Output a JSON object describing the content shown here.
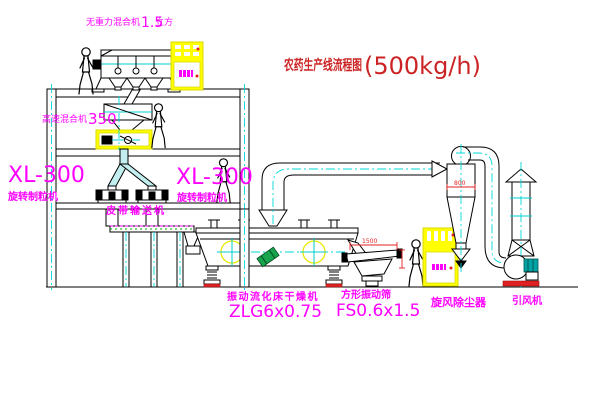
{
  "title": {
    "cn": "农药生产线流程图",
    "capacity": "(500kg/h)"
  },
  "labels": {
    "gravity_mixer": "无重力混合机",
    "gravity_mixer_size": "1.5",
    "gravity_mixer_unit": "立方",
    "hs_mixer": "高速混合机",
    "hs_mixer_model": "350",
    "xl_left_model": "XL-300",
    "xl_left_name": "旋转制粒机",
    "xl_mid_model": "XL-300",
    "xl_mid_name": "旋转制粒机",
    "belt_conveyor": "皮带输送机",
    "dryer_name": "振动流化床干燥机",
    "dryer_model": "ZLG6x0.75",
    "screen_name": "方形振动筛",
    "screen_model": "FS0.6x1.5",
    "cyclone_name": "旋风除尘器",
    "fan_name": "引风机"
  },
  "dimensions": {
    "screen_length": "1500",
    "cyclone_diameter": "800"
  },
  "colors": {
    "label_magenta": "#ff00ff",
    "title_red": "#cc2424",
    "centerline_cyan": "#00d8d8",
    "cabinet_yellow": "#ffff00",
    "line_black": "#000000"
  }
}
